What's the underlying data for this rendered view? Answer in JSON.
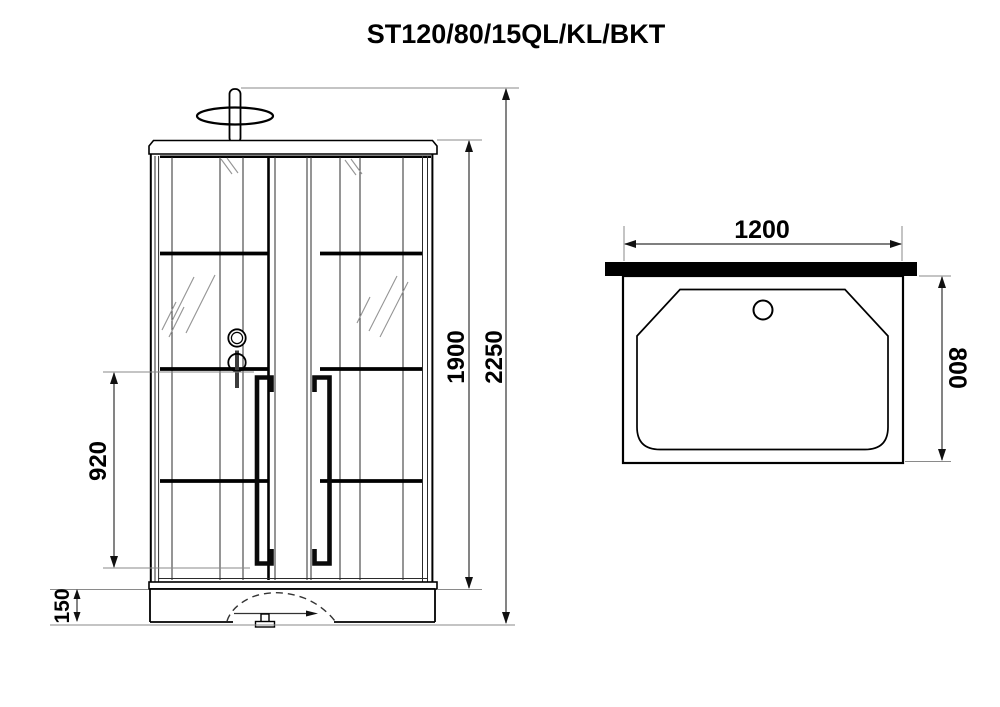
{
  "title": "ST120/80/15QL/KL/BKT",
  "colors": {
    "ink": "#000000",
    "paper": "#ffffff",
    "dimension_line": "#333333",
    "extension_line": "#8a8a8a",
    "lever": "#3c3c3c"
  },
  "front_view": {
    "dims": {
      "overall_height": "2250",
      "cabin_height": "1900",
      "opening_height": "920",
      "tray_height": "150"
    }
  },
  "top_view": {
    "dims": {
      "width": "1200",
      "depth": "800"
    }
  }
}
